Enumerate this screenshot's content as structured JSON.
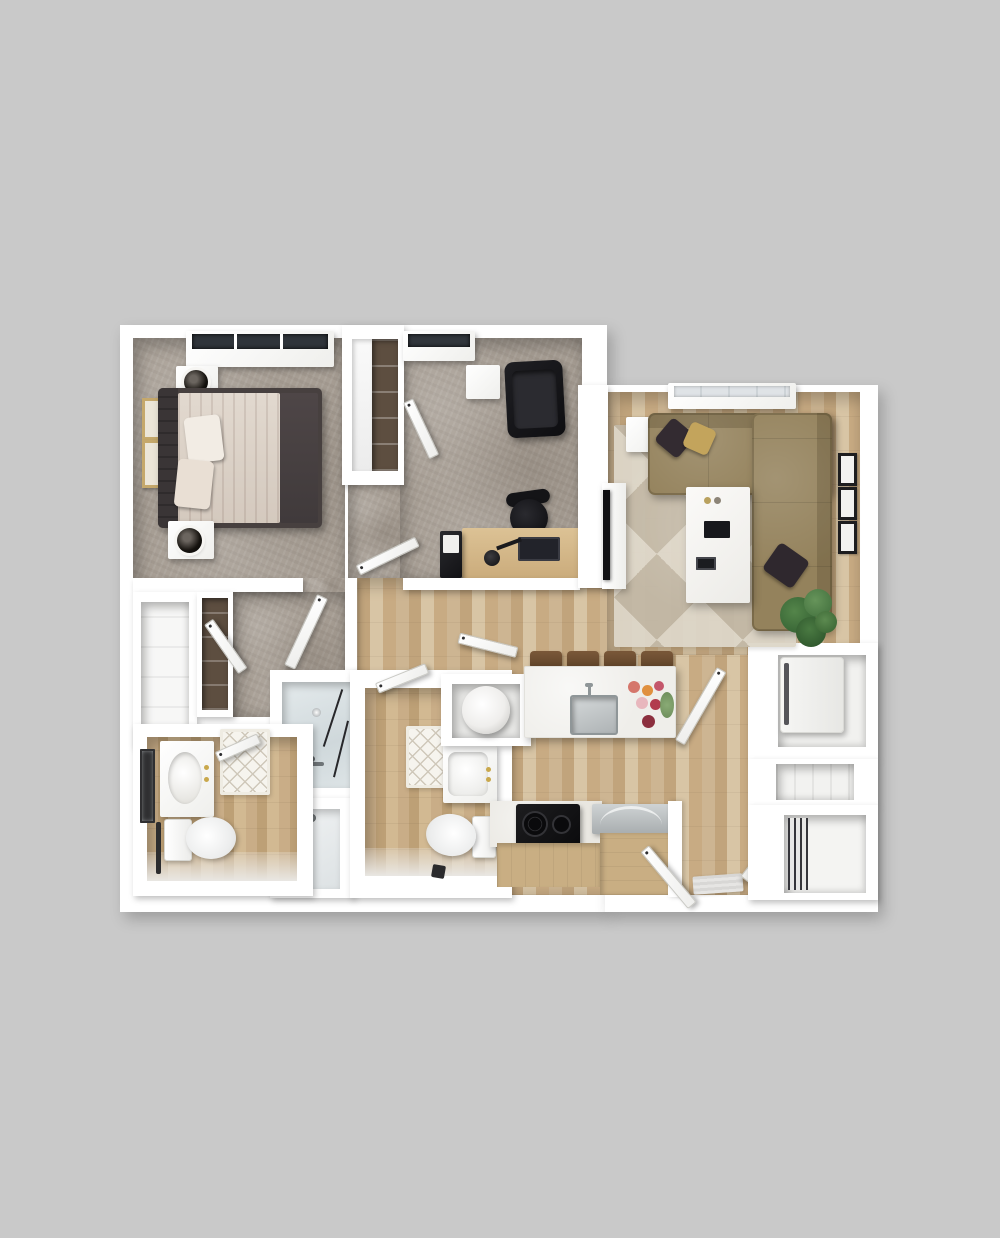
{
  "image": {
    "type": "3d-floorplan-render",
    "description": "Top-down 3D rendering of a two-bedroom, two-bathroom apartment floor plan on a plain gray background. No text labels are rendered in the image.",
    "background_color": "#c9c9c9"
  },
  "palette": {
    "bg": "#c9c9c9",
    "wall": "#ffffff",
    "carpet": "#a69d93",
    "wood": "#cdb592",
    "woodDark": "#c1a47c",
    "woodLight": "#d8c5a5",
    "woodBath": "#c9ad87",
    "glass": "#dce3e6",
    "sofa": "#94825c",
    "rugA": "#ddd6c8",
    "rugB": "#c2b8a6",
    "sheet": "#dbd2c8",
    "blanket": "#4a4243",
    "bedframe": "#47403f",
    "black": "#1b1b1e",
    "counter": "#f0efeb",
    "cabinet": "#c9ae83",
    "steel": "#b7bcbe",
    "gold": "#c9a84c",
    "plantA": "#3f6d3b",
    "plantB": "#54854a",
    "doorEdge": "#c9c9c4",
    "matLine": "#cfc8ba",
    "shelfDark": "#5d4e40"
  },
  "scene": {
    "rooms": [
      {
        "name": "bedroom",
        "floor": "carpet",
        "furniture": [
          "bed",
          "headboard",
          "pillows",
          "nightstand-with-lamp",
          "nightstand-with-lamp",
          "wall-art",
          "wall-art",
          "window"
        ]
      },
      {
        "name": "office-bedroom-2",
        "floor": "carpet",
        "furniture": [
          "desk",
          "office-chair",
          "lounge-chair",
          "side-table",
          "file-cabinet",
          "window",
          "wardrobe-closet"
        ]
      },
      {
        "name": "living-room",
        "floor": "wood",
        "furniture": [
          "l-shaped-sectional-sofa",
          "throw-pillows",
          "coffee-table",
          "side-table",
          "tv-console",
          "tv",
          "geometric-rug",
          "plant",
          "wall-frames",
          "window"
        ]
      },
      {
        "name": "kitchen",
        "floor": "wood",
        "furniture": [
          "island-with-sink",
          "bar-stools",
          "flowers",
          "cooktop",
          "dishwasher",
          "cabinets"
        ]
      },
      {
        "name": "bathroom-1",
        "floor": "wood",
        "furniture": [
          "vanity-sink",
          "mirror",
          "toilet",
          "towel-bar",
          "bath-mat"
        ]
      },
      {
        "name": "bathroom-2",
        "floor": "wood",
        "furniture": [
          "vanity-sink",
          "toilet",
          "bath-mat",
          "waste-bin"
        ]
      },
      {
        "name": "shower-room",
        "floor": "tile",
        "furniture": [
          "glass-shower",
          "glass-tub-enclosure"
        ]
      },
      {
        "name": "utility-closets",
        "floor": "wood",
        "furniture": [
          "washer",
          "water-heater",
          "shelving",
          "linen-closet",
          "wardrobe"
        ]
      },
      {
        "name": "entry",
        "floor": "wood",
        "furniture": [
          "double-doors",
          "door-mat"
        ]
      }
    ]
  }
}
